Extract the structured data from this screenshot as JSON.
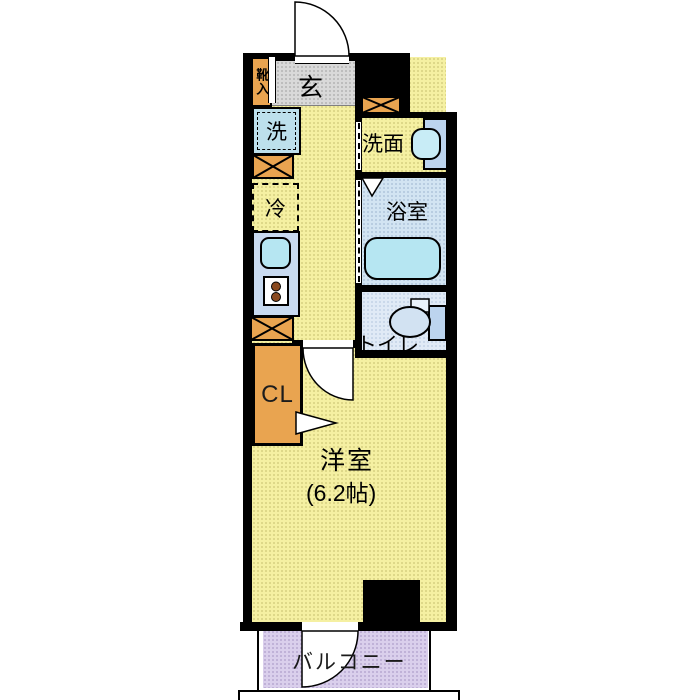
{
  "floorplan": {
    "labels": {
      "entrance": "玄",
      "shoe_box": "靴入",
      "washer": "洗",
      "fridge": "冷",
      "washroom": "洗面",
      "bathroom": "浴室",
      "toilet": "トイレ",
      "closet": "CL",
      "main_room": "洋室",
      "main_room_size": "(6.2帖)",
      "balcony": "バルコニー"
    },
    "colors": {
      "wall_black": "#000000",
      "floor_yellow": "#f5f0a2",
      "entrance_gray": "#d9d9d9",
      "cabinet_orange": "#e9a450",
      "fixture_blue": "#bde0ec",
      "counter_blue": "#c8daf0",
      "bath_floor": "#d2e4f2",
      "toilet_floor": "#e0eaf6",
      "balcony_purple": "#dacfec",
      "tub_blue": "#b6e6f2",
      "vanity_blue": "#bcd4ee",
      "basin_cyan": "#c8ecf6",
      "bowl_blue": "#d2e2f2",
      "burner_brown": "#8a4a20"
    }
  }
}
